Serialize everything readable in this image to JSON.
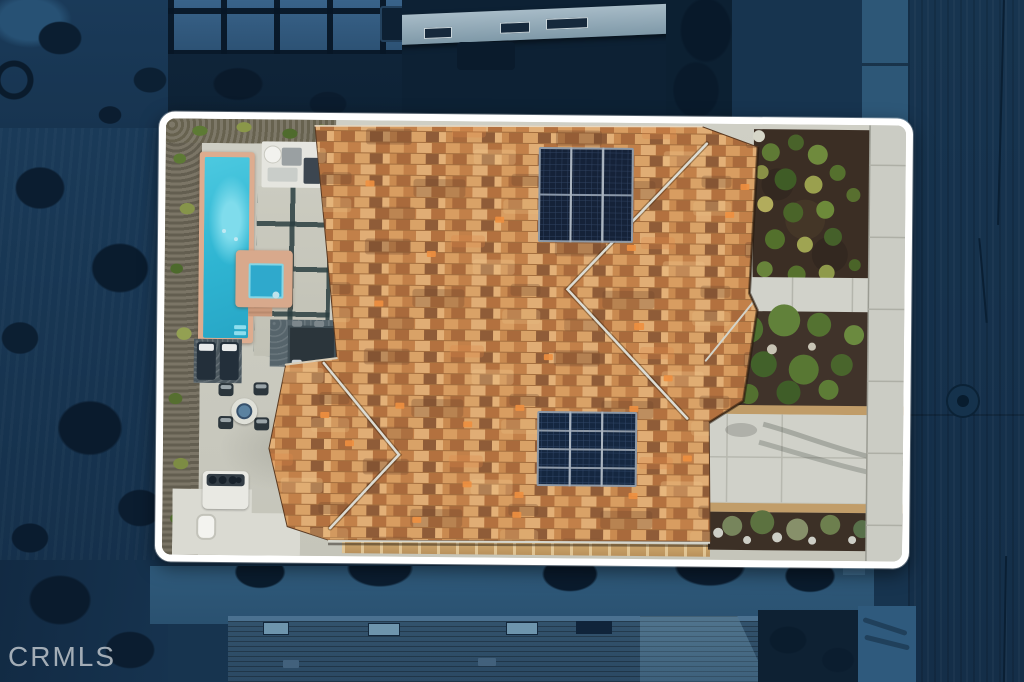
{
  "watermark": {
    "text": "CRMLS",
    "color": "#bdc4ca"
  },
  "scene": {
    "type": "aerial-drone-real-estate-photo",
    "subject": "Top-down view of a single-family home with mixed tan/orange tile roof, two rooftop solar arrays, pool, spa and landscaped yard",
    "lighting": "dusk — everything outside the highlighted lot is darkened deep blue",
    "highlight_frame": {
      "shape": "rounded-rectangle",
      "border_color": "#ffffff"
    },
    "solar_arrays": [
      {
        "position": "upper-roof",
        "rows": 2,
        "columns": 3,
        "panels": 6,
        "panel_color": "#152238"
      },
      {
        "position": "lower-roof",
        "rows": 4,
        "columns": 3,
        "panels": 12,
        "panel_color": "#152740"
      }
    ],
    "amenities": [
      "swimming-pool",
      "spa",
      "paver-patio",
      "outdoor-dining-set",
      "chaise-lounges",
      "fire-pit-table",
      "bbq-grill",
      "pool-equipment",
      "drought-tolerant-landscaping",
      "concrete-driveway",
      "front-walkway",
      "sidewalk"
    ],
    "street_features": [
      "asphalt-road",
      "manhole-cover",
      "concrete-sidewalk",
      "pavement-cracks"
    ],
    "colors": {
      "surroundings_blue": "#16304b",
      "street": "#17344f",
      "roof_tile_base": "#cf9458",
      "roof_tile_dark": "#8f5c38",
      "roof_tile_accent": "#ef9040",
      "pool_water": "#3fc4de",
      "spa_water": "#2fa9cc",
      "pool_coping": "#ddac8f",
      "concrete": "#d0d1c9",
      "mulch": "#3f3126",
      "shrub_green": "#5a7a33",
      "shrub_yellow": "#b0a855",
      "solar_panel": "#16233c"
    }
  }
}
